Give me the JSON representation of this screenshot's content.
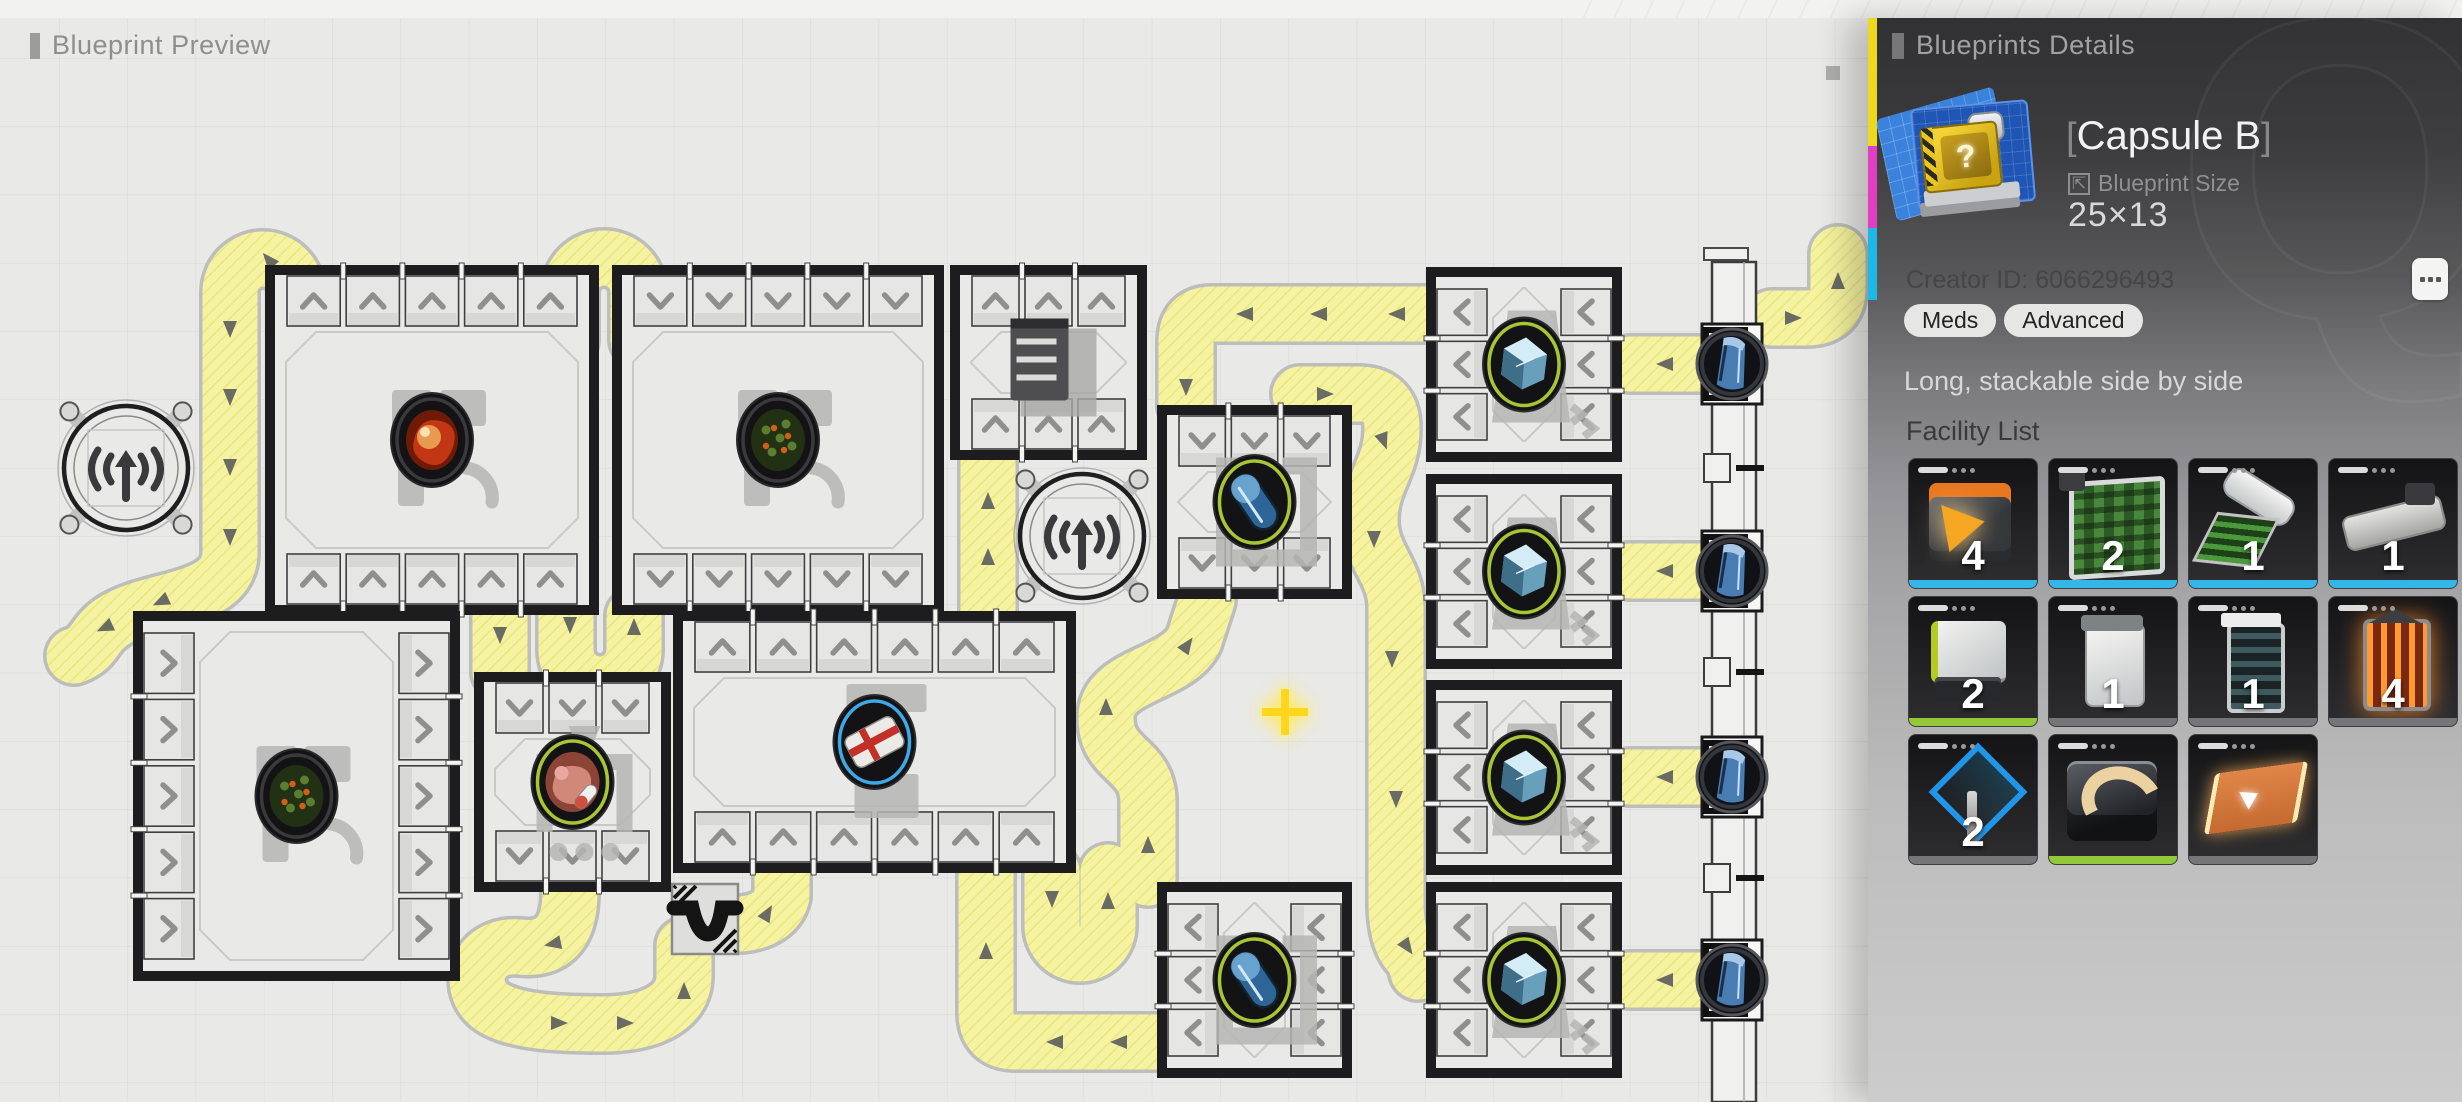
{
  "canvas": {
    "header_label": "Blueprint Preview"
  },
  "panel": {
    "header": "Blueprints Details",
    "bracket_l": "[",
    "bracket_r": "]",
    "title": "Capsule B",
    "size_label": "Blueprint Size",
    "size_value": "25×13",
    "size_icon_glyph": "⇱",
    "creator": "Creator ID: 6066296493",
    "tags": [
      "Meds",
      "Advanced"
    ],
    "description": "Long, stackable side by side",
    "facility_header": "Facility List",
    "watermark_letter": "Q",
    "accent_colors": {
      "cyan": "#35b6e9",
      "green": "#93c83a",
      "gray": "#75757a"
    },
    "facilities": [
      {
        "icon": "crusher",
        "count": "4",
        "bar": "cyan"
      },
      {
        "icon": "planter",
        "count": "2",
        "bar": "cyan"
      },
      {
        "icon": "reaper",
        "count": "1",
        "bar": "cyan"
      },
      {
        "icon": "press",
        "count": "1",
        "bar": "cyan"
      },
      {
        "icon": "mixer",
        "count": "2",
        "bar": "green"
      },
      {
        "icon": "cabinet",
        "count": "1",
        "bar": "gray"
      },
      {
        "icon": "aggregator",
        "count": "1",
        "bar": "gray"
      },
      {
        "icon": "furnace",
        "count": "4",
        "bar": "gray"
      },
      {
        "icon": "signal",
        "count": "2",
        "bar": "gray"
      },
      {
        "icon": "sorter",
        "count": "",
        "bar": "green"
      },
      {
        "icon": "belt",
        "count": "",
        "bar": "gray"
      }
    ]
  },
  "blueprint": {
    "width": 1868,
    "height": 1102,
    "colors": {
      "bg": "#e9e9e7",
      "grid": "#d9d9d7",
      "belt": "#f5f3a1",
      "belt_hatch": "#e8e67c",
      "belt_edge": "#bdbdbb",
      "wall": "#1d1d1f",
      "slot": "#e6e6e4",
      "chevron": "#8f8f8d",
      "arrow": "#5c5c5e",
      "ring_green": "#a8c634",
      "ring_blue": "#3fa8e8",
      "ring_dark": "#3a3a3c",
      "shadow": "#b5b5b3"
    },
    "grid": {
      "size": 68.3,
      "ox": 59,
      "oy": 58
    },
    "towers": [
      {
        "x": 126,
        "y": 468
      },
      {
        "x": 1082,
        "y": 536
      }
    ],
    "rooms": [
      {
        "id": "grow-room-nw",
        "x": 270,
        "y": 270,
        "w": 324,
        "h": 340,
        "ports": {
          "top": [
            5,
            "up"
          ],
          "bottom": [
            5,
            "up"
          ]
        },
        "item": "berry",
        "ring": "dark",
        "shadow": "farm"
      },
      {
        "id": "grow-room-n",
        "x": 617,
        "y": 270,
        "w": 322,
        "h": 340,
        "ports": {
          "top": [
            5,
            "down"
          ],
          "bottom": [
            5,
            "down"
          ]
        },
        "item": "plant",
        "ring": "dark",
        "shadow": "farm"
      },
      {
        "id": "storage-room",
        "x": 955,
        "y": 270,
        "w": 187,
        "h": 185,
        "ports": {
          "top": [
            3,
            "up"
          ],
          "bottom": [
            3,
            "up"
          ]
        },
        "item": "shelf",
        "ring": "none",
        "shadow": "none"
      },
      {
        "id": "capsule-room-n",
        "x": 1162,
        "y": 410,
        "w": 185,
        "h": 184,
        "ports": {
          "top": [
            3,
            "down"
          ],
          "bottom": [
            3,
            "down"
          ]
        },
        "item": "capsule",
        "ring": "green",
        "shadow": "capsule"
      },
      {
        "id": "grow-room-w",
        "x": 138,
        "y": 616,
        "w": 317,
        "h": 360,
        "ports": {
          "left": [
            5,
            "right"
          ],
          "right": [
            5,
            "right"
          ]
        },
        "item": "plant",
        "ring": "dark",
        "shadow": "farm"
      },
      {
        "id": "meat-room",
        "x": 479,
        "y": 677,
        "w": 187,
        "h": 210,
        "ports": {
          "top": [
            3,
            "down"
          ],
          "bottom": [
            3,
            "down"
          ]
        },
        "item": "meat",
        "ring": "green",
        "shadow": "meat"
      },
      {
        "id": "process-room",
        "x": 678,
        "y": 616,
        "w": 393,
        "h": 252,
        "ports": {
          "top": [
            6,
            "up"
          ],
          "bottom": [
            6,
            "up"
          ]
        },
        "item": "medkit",
        "ring": "blue",
        "shadow": "medkit"
      },
      {
        "id": "cube-room-1",
        "x": 1431,
        "y": 272,
        "w": 186,
        "h": 185,
        "ports": {
          "left": [
            3,
            "left"
          ],
          "right": [
            3,
            "left"
          ]
        },
        "item": "cube",
        "ring": "green",
        "shadow": "cube"
      },
      {
        "id": "cube-room-2",
        "x": 1431,
        "y": 479,
        "w": 186,
        "h": 185,
        "ports": {
          "left": [
            3,
            "left"
          ],
          "right": [
            3,
            "left"
          ]
        },
        "item": "cube",
        "ring": "green",
        "shadow": "cube"
      },
      {
        "id": "cube-room-3",
        "x": 1431,
        "y": 685,
        "w": 186,
        "h": 185,
        "ports": {
          "left": [
            3,
            "left"
          ],
          "right": [
            3,
            "left"
          ]
        },
        "item": "cube",
        "ring": "green",
        "shadow": "cube"
      },
      {
        "id": "capsule-room-s",
        "x": 1162,
        "y": 887,
        "w": 185,
        "h": 186,
        "ports": {
          "left": [
            3,
            "left"
          ],
          "right": [
            3,
            "left"
          ]
        },
        "item": "capsule",
        "ring": "green",
        "shadow": "capsule"
      },
      {
        "id": "cube-room-4",
        "x": 1431,
        "y": 887,
        "w": 186,
        "h": 186,
        "ports": {
          "left": [
            3,
            "left"
          ],
          "right": [
            3,
            "left"
          ]
        },
        "item": "cube",
        "ring": "green",
        "shadow": "cube"
      }
    ],
    "conveyors": [
      "M 296 352 L 296 292 A 33 33 0 0 0 230 292 L 230 552 C 230 604 150 596 112 622 C 92 636 96 648 74 656",
      "M 570 340 L 570 292 A 34 34 0 0 1 638 292 L 638 340",
      "M 1425 314 L 1212 314 Q 1186 314 1186 342 L 1186 406",
      "M 1300 394 L 1358 394 Q 1392 394 1392 428 C 1392 468 1370 482 1370 520 C 1370 558 1396 570 1396 608 L 1396 902 Q 1396 944 1414 958 L 1418 972",
      "M 1156 1042 L 1016 1042 Q 986 1042 986 1012 L 986 874",
      "M 1052 872 L 1052 926 A 28 28 0 0 0 1108 926 L 1108 872",
      "M 570 892 C 570 938 548 950 520 947 C 478 943 466 984 488 1004 C 508 1022 560 1024 602 1024 C 650 1024 684 1008 684 976 L 684 946",
      "M 742 924 Q 776 920 782 896 L 782 872",
      "M 988 462 L 988 610",
      "M 1148 878 L 1148 802 C 1148 758 1106 762 1106 718 C 1106 674 1176 676 1194 640 L 1207 600",
      "M 1772 318 L 1806 318 Q 1838 318 1838 288 L 1838 254",
      "M 566 616 L 566 650 A 34 34 0 0 0 634 650 L 634 616",
      "M 500 616 L 500 672",
      "M 1630 364 L 1704 364",
      "M 1630 571 L 1704 571",
      "M 1630 777 L 1704 777",
      "M 1630 980 L 1704 980"
    ],
    "arrows": [
      [
        296,
        324,
        -90
      ],
      [
        268,
        259,
        -130
      ],
      [
        230,
        330,
        90
      ],
      [
        230,
        398,
        90
      ],
      [
        230,
        468,
        90
      ],
      [
        230,
        538,
        90
      ],
      [
        160,
        602,
        155
      ],
      [
        104,
        628,
        155
      ],
      [
        572,
        310,
        100
      ],
      [
        636,
        310,
        -80
      ],
      [
        1396,
        314,
        180
      ],
      [
        1318,
        314,
        180
      ],
      [
        1244,
        314,
        180
      ],
      [
        1186,
        388,
        90
      ],
      [
        1326,
        394,
        0
      ],
      [
        1384,
        442,
        70
      ],
      [
        1374,
        540,
        90
      ],
      [
        1392,
        660,
        90
      ],
      [
        1396,
        800,
        90
      ],
      [
        1408,
        948,
        55
      ],
      [
        1118,
        1042,
        180
      ],
      [
        1054,
        1042,
        180
      ],
      [
        986,
        950,
        -90
      ],
      [
        1052,
        900,
        90
      ],
      [
        1108,
        900,
        -90
      ],
      [
        552,
        944,
        168
      ],
      [
        560,
        1023,
        0
      ],
      [
        626,
        1023,
        0
      ],
      [
        684,
        990,
        -90
      ],
      [
        768,
        912,
        -60
      ],
      [
        988,
        556,
        -90
      ],
      [
        988,
        500,
        -90
      ],
      [
        1148,
        844,
        -90
      ],
      [
        1106,
        706,
        -90
      ],
      [
        1188,
        644,
        -55
      ],
      [
        1794,
        318,
        0
      ],
      [
        1838,
        280,
        -90
      ],
      [
        570,
        626,
        90
      ],
      [
        634,
        626,
        -90
      ],
      [
        500,
        636,
        90
      ],
      [
        1664,
        364,
        180
      ],
      [
        1664,
        571,
        180
      ],
      [
        1664,
        777,
        180
      ],
      [
        1664,
        980,
        180
      ]
    ],
    "underpass": {
      "x": 672,
      "y": 884,
      "w": 66,
      "h": 70
    },
    "structure": {
      "x": 1712,
      "w": 44,
      "top": 262,
      "circles": [
        364,
        571,
        777,
        980
      ],
      "notches": [
        468,
        672,
        878
      ]
    },
    "cursor": {
      "x": 1285,
      "y": 712
    }
  }
}
